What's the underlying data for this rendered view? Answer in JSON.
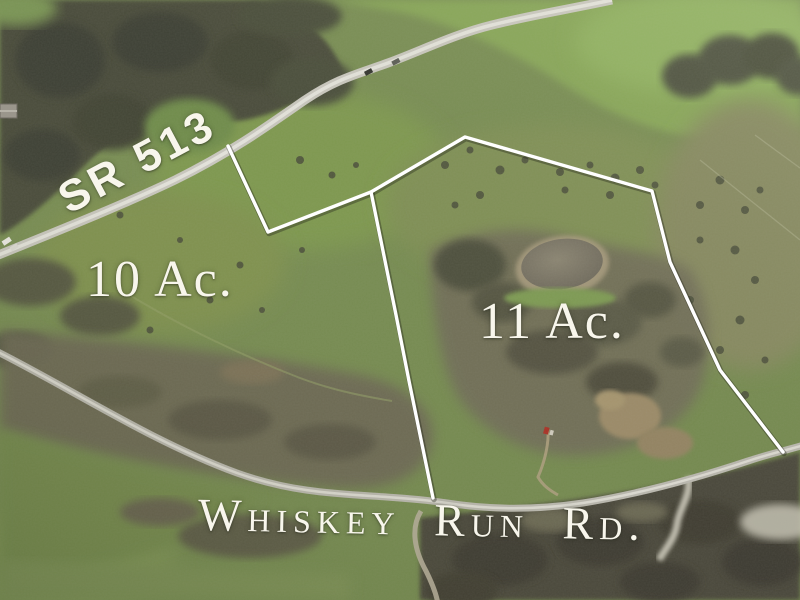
{
  "scene": {
    "type": "aerial-parcel-photo",
    "description": "Aerial real-estate photo with surveyed parcel boundary overlay"
  },
  "labels": {
    "sr513": "SR 513",
    "parcel_left_acreage": "10 Ac.",
    "parcel_right_acreage": "11 Ac.",
    "whiskey_run": "Whiskey Run Rd."
  },
  "palette": {
    "boundary_white": "#ffffff",
    "label_white": "#f8f6ec",
    "field_green": "#7d915a",
    "bright_green": "#86a557",
    "forest_dark": "#45483a",
    "scrub_gray": "#6e6a57",
    "road_gray": "#c9c7bf",
    "pond_gray": "#77705f",
    "dirt_tan": "#9b8a67"
  },
  "geometry": {
    "boundary_outline_points": "228,146 268,232 371,192 465,137 652,191 670,262 720,370 783,452",
    "divider_points": "371,192 396,315 409,381 433,498",
    "sr513_road_d": "M -4 256 C 60 230 125 204 175 180 C 228 154 265 128 305 100 C 338 78 358 74 388 63 C 423 50 455 34 492 25 C 532 15 565 10 612 0",
    "whiskey_road_d": "M -4 351 C 70 388 150 441 237 473 C 312 500 372 492 447 503 C 497 511 543 509 583 503 C 645 493 700 477 748 461 C 772 453 788 450 804 445",
    "driveway_d": "M 421 511 C 410 529 415 551 426 571 C 431 581 436 592 438 604",
    "farm_trail_d": "M 548 429 C 549 443 545 461 538 477 C 543 486 551 491 558 495",
    "left_trail_d": "M 128 294 C 180 326 243 356 300 378 C 332 390 362 396 392 401",
    "creek_d": "M 688 477 C 692 494 679 509 677 524 C 675 539 665 549 659 560"
  }
}
